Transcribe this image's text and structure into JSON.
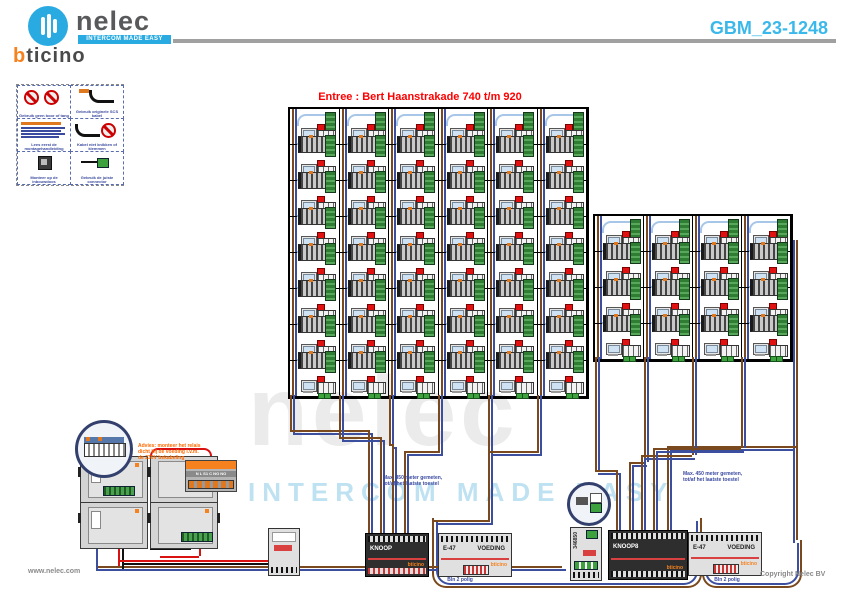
{
  "header": {
    "brand": "nelec",
    "brand_tagline": "INTERCOM MADE EASY",
    "partner_brand_prefix": "b",
    "partner_brand_suffix": "ticino",
    "doc_number": "GBM_23-1248"
  },
  "title": "Entree : Bert Haanstrakade 740 t/m 920",
  "watermark": {
    "word": "nelec",
    "tagline": "INTERCOM MADE EASY"
  },
  "legend": {
    "cells": [
      {
        "caption": "Gebruik geen boor of tang"
      },
      {
        "caption": "Gebruik originele SCS kabel"
      },
      {
        "caption": "Lees eerst de montagehandleiding"
      },
      {
        "caption": "Kabel niet knikken of klemmen"
      },
      {
        "caption": "Monteer op de inbouwdoos"
      },
      {
        "caption": "Gebruik de juiste connector"
      }
    ]
  },
  "grids": {
    "left": {
      "cols": 6,
      "rows": 8
    },
    "right": {
      "cols": 4,
      "rows": 4
    }
  },
  "annotations": {
    "advice": [
      "Advies: monteer het relais",
      "dicht bij de voeding i.v.m.",
      "de 230V bekabeling"
    ],
    "left_note": [
      "Max. 450 meter gemeten,",
      "tot/af het laatste toestel"
    ],
    "right_note": [
      "Max. 450 meter gemeten,",
      "tot/af het laatste toestel"
    ]
  },
  "relay": {
    "terminals": "N L S1 C NO NO"
  },
  "modules": {
    "brand": "bticino",
    "knoop": {
      "label": "KNOOP"
    },
    "e47a": {
      "label": "E-47",
      "label2": "VOEDING"
    },
    "knoop8": {
      "label": "KNOOP8"
    },
    "e47b": {
      "label": "E-47",
      "label2": "VOEDING"
    },
    "din_small": {
      "label": "346850"
    },
    "caption_left": "Bln 2 polig",
    "caption_right": "Bln 2 polig"
  },
  "footer": {
    "website": "www.nelec.com",
    "copyright": "Copyright Nelec BV"
  }
}
